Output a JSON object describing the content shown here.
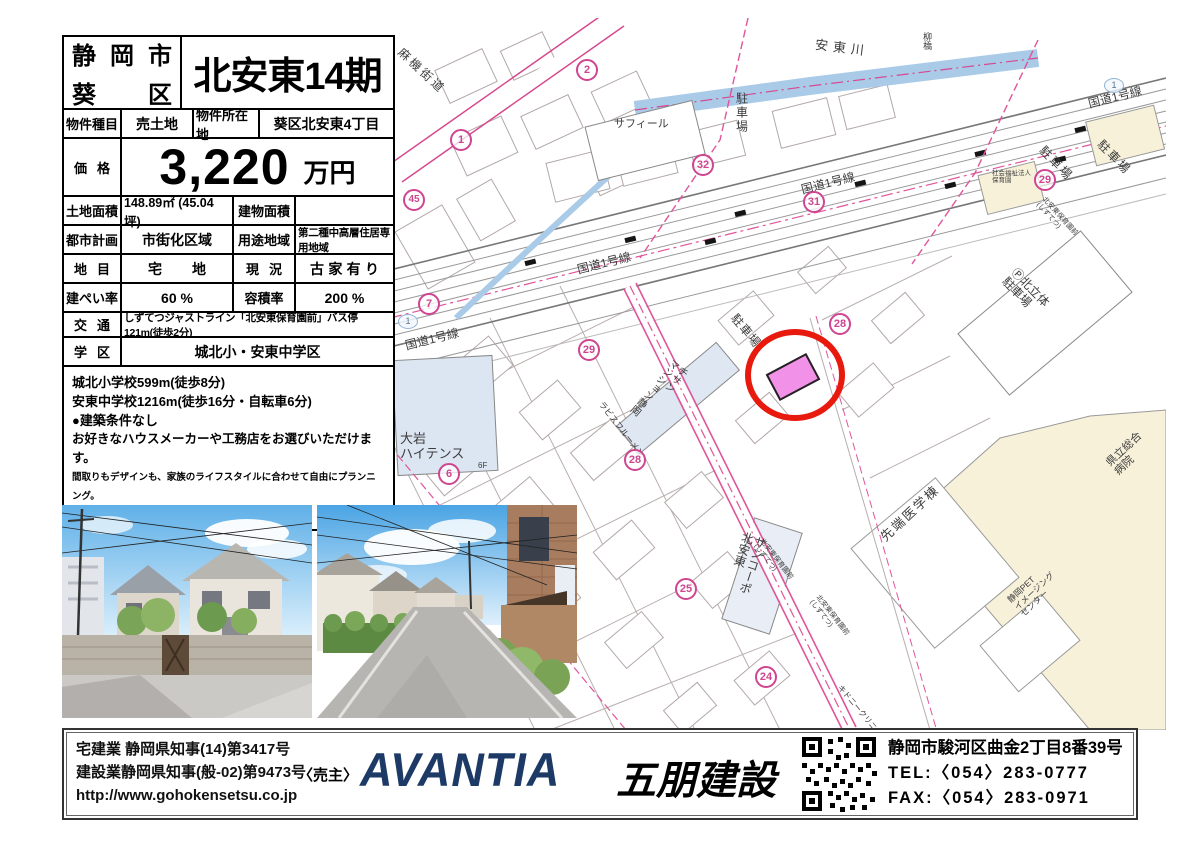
{
  "header": {
    "city_line1": "静岡市",
    "city_line2": "葵区",
    "title": "北安東14期"
  },
  "table": {
    "r1": {
      "l1": "物件種目",
      "v1": "売土地",
      "l2": "物件所在地",
      "v2": "葵区北安東4丁目"
    },
    "price": {
      "label": "価格",
      "value": "3,220",
      "unit": "万円"
    },
    "area": {
      "l1": "土地面積",
      "v1": "148.89㎡ (45.04坪)",
      "l2": "建物面積",
      "v2": ""
    },
    "plan": {
      "l1": "都市計画",
      "v1": "市街化区域",
      "l2": "用途地域",
      "v2": "第二種中高層住居専用地域"
    },
    "land": {
      "l1": "地目",
      "v1": "宅地",
      "l2": "現況",
      "v2": "古家有り"
    },
    "ratio": {
      "l1": "建ぺい率",
      "v1": "60 %",
      "l2": "容積率",
      "v2": "200 %"
    },
    "transport": {
      "label": "交通",
      "value": "しずてつジャストライン「北安東保育園前」バス停121m(徒歩2分)"
    },
    "school": {
      "label": "学区",
      "value": "城北小・安東中学区"
    },
    "notes": [
      "城北小学校599m(徒歩8分)",
      "安東中学校1216m(徒歩16分・自転車6分)",
      "●建築条件なし",
      "お好きなハウスメーカーや工務店をお選びいただけます。",
      "間取りもデザインも、家族のライフスタイルに合わせて自由にプランニング。",
      "●解体更地渡し"
    ]
  },
  "map": {
    "labels": [
      "麻機街道",
      "安東川",
      "柳橋",
      "国道1号線",
      "国道1号線",
      "国道1号線",
      "国道1号線",
      "駐車場",
      "駐車場",
      "駐車場",
      "駐車場",
      "Ⓟ北立体\n駐車場",
      "サフィール",
      "チサン\nマンション静岡",
      "大岩\nハイテンス",
      "6F",
      "サンコーポ\n北安東",
      "先端医学棟",
      "県立総合\n病院",
      "静岡PET\nイメージング\nセンター",
      "北安東保育園前\n(しずてつ)",
      "北安東保育園前\n(しずてつ)",
      "北安東保育園前\n(しずてつ)",
      "社会福祉法人\n保育園",
      "ラビスフルーメン",
      "キドニークリニック"
    ],
    "badges": [
      "1",
      "2",
      "45",
      "32",
      "31",
      "29",
      "29",
      "28",
      "28",
      "7",
      "6",
      "25",
      "24"
    ],
    "shield": "1",
    "colors": {
      "accent_pink": "#cf4590",
      "river": "#a9cbe8",
      "marker_red": "#e8190d",
      "parcel_pink": "#f291e8"
    }
  },
  "footer": {
    "license1": "宅建業 静岡県知事(14)第3417号",
    "license2": "建設業静岡県知事(般-02)第9473号",
    "url": "http://www.gohokensetsu.co.jp",
    "seller": "〈売主〉",
    "brand": "AVANTIA",
    "company": "五朋建設",
    "address": "静岡市駿河区曲金2丁目8番39号",
    "tel": "TEL:〈054〉283-0777",
    "fax": "FAX:〈054〉283-0971"
  }
}
